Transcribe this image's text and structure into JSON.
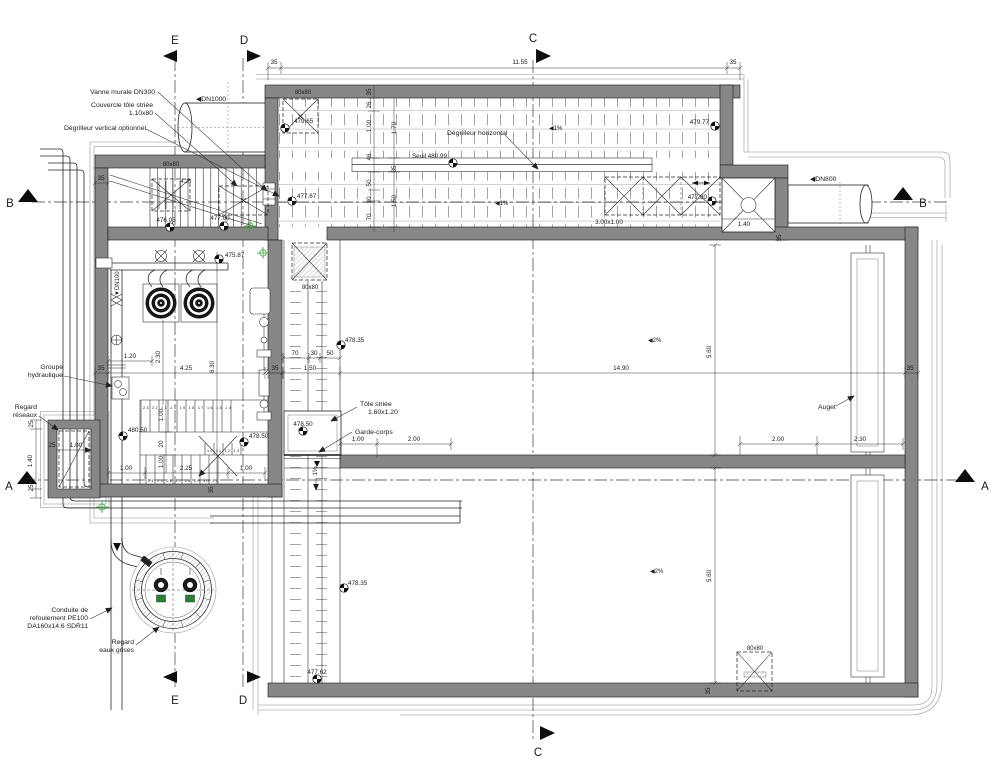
{
  "markers": {
    "a": "A",
    "b": "B",
    "c": "C",
    "d": "D",
    "e": "E"
  },
  "dims": {
    "d35": "35",
    "d26": "26",
    "d25": "25",
    "d20": "20",
    "d30": "30",
    "d46": "46",
    "d50": "50",
    "d70": "70",
    "d80": "80x80",
    "d1_00": "1.00",
    "d1_20": "1.20",
    "d1_40": "1.40",
    "d1_50": "1.50",
    "d1_70": "1.70",
    "d2_00": "2.00",
    "d2_25": "2.25",
    "d2_30": "2.30",
    "d4_25": "4.25",
    "d5_60": "5.60",
    "d6_30": "6.30",
    "d11_55": "11.55",
    "d14_90": "14.90",
    "d3x1": "3.00x1.00",
    "pct1": "1%"
  },
  "levels": {
    "l479_65": "479.65",
    "l479_77": "479.77",
    "l477_67": "477.67",
    "l477_80": "477.80",
    "l476_05": "476.05",
    "l477_00": "477.00",
    "l475_87": "475.87",
    "l480_50": "480.50",
    "l478_50": "478.50",
    "l478_35": "478.35",
    "l477_62": "477.62",
    "seuil": "Seuil 480.99"
  },
  "flow": {
    "dn1000": "◀DN1000",
    "dn800": "◀DN800",
    "dn100": "▼DN100",
    "slope1": "◀1%",
    "slope2": "◀2%"
  },
  "callouts": {
    "vanne": "Vanne murale DN300",
    "couv1": "Couvercle tôle striée",
    "couv2": "1.10x80",
    "degv": "Dégrilleur vertical optionnel",
    "degh": "Dégrilleur horizontal",
    "grp1": "Groupe",
    "grp2": "hydraulique",
    "rr1": "Regard",
    "rr2": "réseaux",
    "tole1": "Tôle striée",
    "tole2": "1.60x1.20",
    "garde": "Garde-corps",
    "auget": "Auget",
    "cond1": "Conduite de",
    "cond2": "refoulement PE100",
    "cond3": "DA160x14.6 SDR11",
    "reg1": "Regard",
    "reg2": "eaux grises"
  },
  "stairs": {
    "top": "23 22 21 20 19 18 17 16 15 14",
    "mid": "10 11 12 13",
    "bottom": "24 25 26 27 28 29 30 31"
  },
  "colors": {
    "wall": "#878787",
    "line": "#1b1b1b",
    "topo": "#3fa33f"
  }
}
